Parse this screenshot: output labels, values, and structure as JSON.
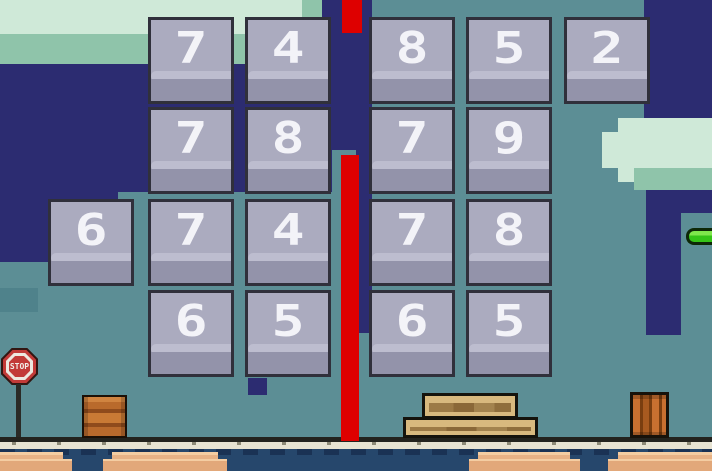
{
  "game": {
    "scene": "number-blocks-level",
    "stop_sign_text": "STOP"
  },
  "blocks": [
    {
      "row": 0,
      "col": 1,
      "value": "7"
    },
    {
      "row": 0,
      "col": 2,
      "value": "4"
    },
    {
      "row": 0,
      "col": 3,
      "value": "8"
    },
    {
      "row": 0,
      "col": 4,
      "value": "5"
    },
    {
      "row": 0,
      "col": 5,
      "value": "2"
    },
    {
      "row": 1,
      "col": 1,
      "value": "7"
    },
    {
      "row": 1,
      "col": 2,
      "value": "8"
    },
    {
      "row": 1,
      "col": 3,
      "value": "7"
    },
    {
      "row": 1,
      "col": 4,
      "value": "9"
    },
    {
      "row": 2,
      "col": 0,
      "value": "6"
    },
    {
      "row": 2,
      "col": 1,
      "value": "7"
    },
    {
      "row": 2,
      "col": 2,
      "value": "4"
    },
    {
      "row": 2,
      "col": 3,
      "value": "7"
    },
    {
      "row": 2,
      "col": 4,
      "value": "8"
    },
    {
      "row": 3,
      "col": 1,
      "value": "6"
    },
    {
      "row": 3,
      "col": 2,
      "value": "5"
    },
    {
      "row": 3,
      "col": 3,
      "value": "6"
    },
    {
      "row": 3,
      "col": 4,
      "value": "5"
    }
  ],
  "colors": {
    "background_teal": "#5C8E95",
    "sky_navy": "#2C2C71",
    "cloud_mint": "#CFE9D8",
    "cloud_sage": "#8FC4AA",
    "hazard_red": "#DE0000",
    "block_face": "#ABABBF",
    "block_face_bottom": "#9393AA",
    "block_highlight": "#BDBDCF",
    "block_number": "#F3F3F8",
    "projectile_green": "#35C518",
    "water_blue": "#26476C",
    "sand_tan": "#E8B285",
    "wood_tan": "#D8B97E",
    "crate_orange": "#C87030",
    "stop_sign_red": "#C23A38"
  }
}
